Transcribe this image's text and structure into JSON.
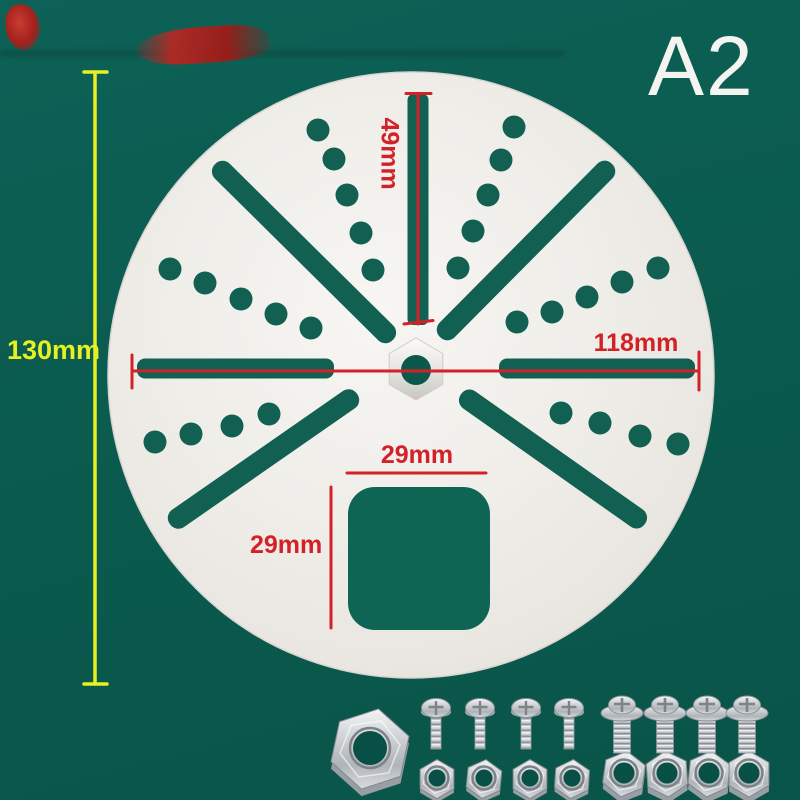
{
  "scene": {
    "variant_label": "A2",
    "background_color": "#0a5a4e",
    "plate_color": "#efece7",
    "cutout_color": "#116051"
  },
  "annotations": {
    "plate_height": "130mm",
    "top_slot_length": "49mm",
    "side_slot_span": "118mm",
    "square_hole_width": "29mm",
    "square_hole_height": "29mm",
    "red_line_color": "#d42127",
    "yellow_line_color": "#e8f021"
  },
  "hardware": {
    "large_hex_nut_count": 1,
    "pan_head_screw_count": 4,
    "small_hex_nut_count": 4,
    "flange_bolt_count": 4,
    "bolt_hex_nut_count": 4
  }
}
